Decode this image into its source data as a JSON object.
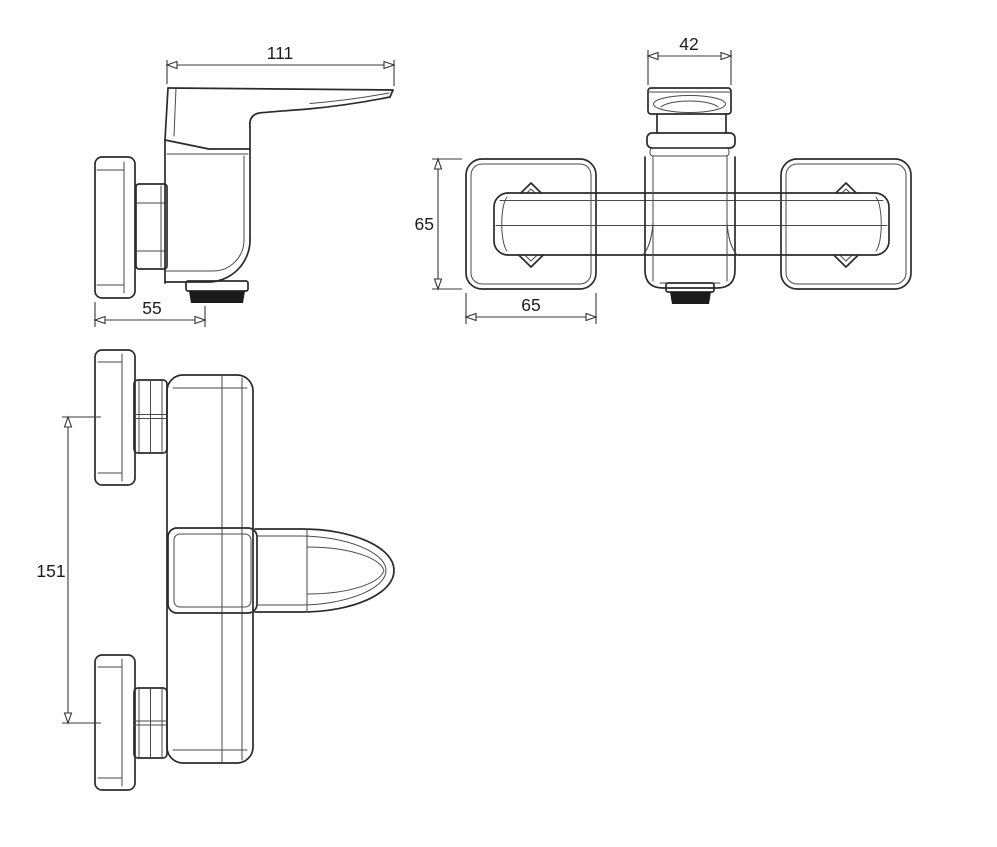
{
  "colors": {
    "background": "#ffffff",
    "line": "#2b2b2b",
    "dimension_text": "#1c1c1c",
    "spout_fill": "#1b1b1b"
  },
  "views": {
    "side": {
      "dims": {
        "handle_length": "111",
        "wall_to_spout": "55"
      }
    },
    "top": {
      "dims": {
        "handle_width": "42",
        "escutcheon_height": "65",
        "escutcheon_width": "65"
      }
    },
    "front": {
      "dims": {
        "connection_spacing": "151"
      }
    }
  }
}
